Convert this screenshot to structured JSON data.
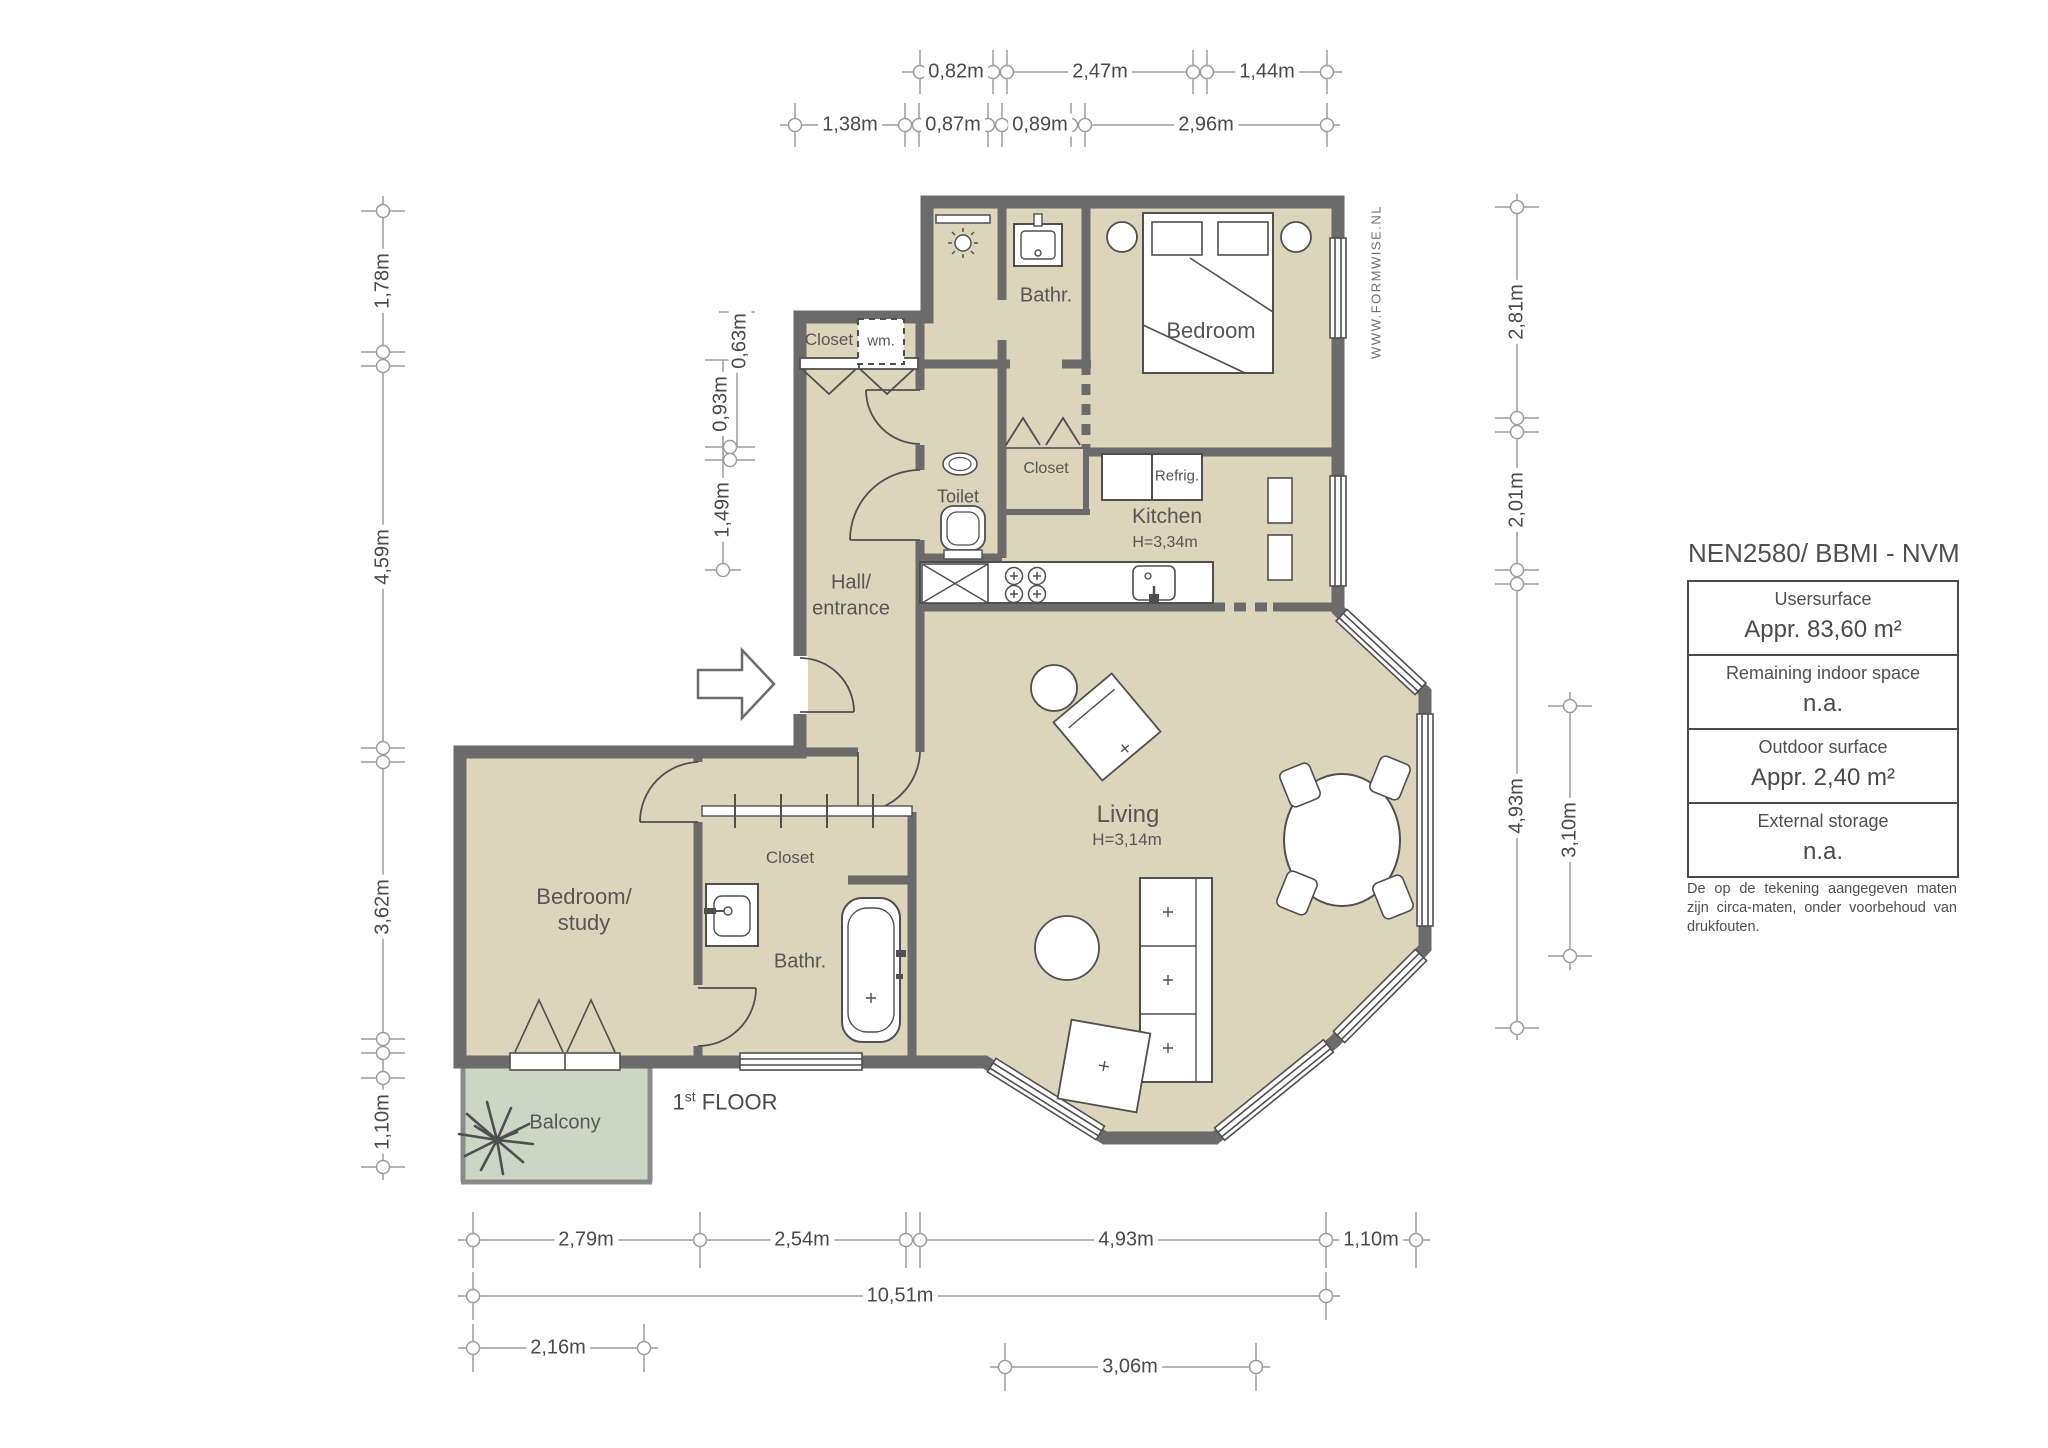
{
  "meta": {
    "brand": "WWW.FORMWISE.NL",
    "floor_num": "1",
    "floor_sup": "st",
    "floor_rest": " FLOOR"
  },
  "rooms": {
    "bathroom_top": "Bathr.",
    "bedroom_top": "Bedroom",
    "closet_top": "Closet",
    "wm": "wm.",
    "toilet": "Toilet",
    "closet_mid": "Closet",
    "refrig": "Refrig.",
    "kitchen": "Kitchen",
    "kitchen_height": "H=3,34m",
    "hall_line1": "Hall/",
    "hall_line2": "entrance",
    "living": "Living",
    "living_height": "H=3,14m",
    "bedroom_study_line1": "Bedroom/",
    "bedroom_study_line2": "study",
    "closet_bottom": "Closet",
    "bathroom_bottom": "Bathr.",
    "balcony": "Balcony"
  },
  "dimensions": {
    "top_row1": [
      "0,82m",
      "2,47m",
      "1,44m"
    ],
    "top_row2": [
      "1,38m",
      "0,87m",
      "0,89m",
      "2,96m"
    ],
    "left_outer": [
      "1,78m",
      "4,59m",
      "3,62m",
      "1,10m"
    ],
    "left_inner": [
      "0,63m",
      "0,93m",
      "1,49m"
    ],
    "right_outer": [
      "2,81m",
      "2,01m",
      "4,93m"
    ],
    "right_inner": [
      "3,10m"
    ],
    "bottom_row1": [
      "2,79m",
      "2,54m",
      "4,93m",
      "1,10m"
    ],
    "bottom_row2": [
      "10,51m"
    ],
    "bottom_row3": [
      "2,16m"
    ],
    "bottom_row4": [
      "3,06m"
    ]
  },
  "info_panel": {
    "title": "NEN2580/ BBMI - NVM",
    "rows": [
      {
        "label": "Usersurface",
        "value": "Appr. 83,60 m²"
      },
      {
        "label": "Remaining indoor space",
        "value": "n.a."
      },
      {
        "label": "Outdoor surface",
        "value": "Appr. 2,40 m²"
      },
      {
        "label": "External storage",
        "value": "n.a."
      }
    ],
    "disclaimer": "De op de tekening aangegeven maten zijn circa-maten, onder voorbehoud van drukfouten."
  },
  "colors": {
    "wall": "#6b6b6b",
    "floor": "#ddd5bb",
    "balcony_floor": "#ccd6c5",
    "dim_line": "#9c9c9c",
    "furniture_line": "#4f4f4f"
  }
}
